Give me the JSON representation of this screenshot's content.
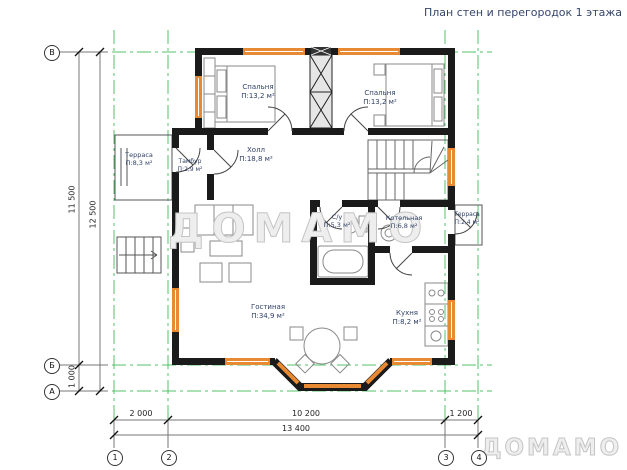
{
  "title": "План стен и перегородок 1 этажа",
  "watermark": {
    "text": "ДОМАМО"
  },
  "rooms": {
    "bedroom_left": {
      "name": "Спальня",
      "area": "П:13,2 м²"
    },
    "bedroom_right": {
      "name": "Спальня",
      "area": "П:13,2 м²"
    },
    "terrace_left": {
      "name": "Терраса",
      "area": "П:8,3 м²"
    },
    "tambour": {
      "name": "Тамбур",
      "area": "П:2,9 м²"
    },
    "hall": {
      "name": "Холл",
      "area": "П:18,8 м²"
    },
    "wc": {
      "name": "С/у",
      "area": "П:5,3 м²"
    },
    "boiler": {
      "name": "Котельная",
      "area": "П:6,8 м²"
    },
    "terrace_right": {
      "name": "Терраса",
      "area": "П:2,4 м²"
    },
    "living": {
      "name": "Гостиная",
      "area": "П:34,9 м²"
    },
    "kitchen": {
      "name": "Кухня",
      "area": "П:8,2 м²"
    }
  },
  "dimensions": {
    "horizontal": {
      "d1": "2 000",
      "d2": "10 200",
      "d3": "1 200",
      "total": "13 400"
    },
    "vertical": {
      "d1": "11 500",
      "d2": "1 000",
      "total": "12 500"
    }
  },
  "axes": {
    "columns": [
      "1",
      "2",
      "3",
      "4"
    ],
    "rows": [
      "В",
      "Б",
      "А"
    ]
  },
  "colors": {
    "wall": "#1b1b1b",
    "window": "#e88a33",
    "axis_line": "#53c168",
    "room_label": "#2e3f66",
    "watermark": "#c4c4c4"
  }
}
